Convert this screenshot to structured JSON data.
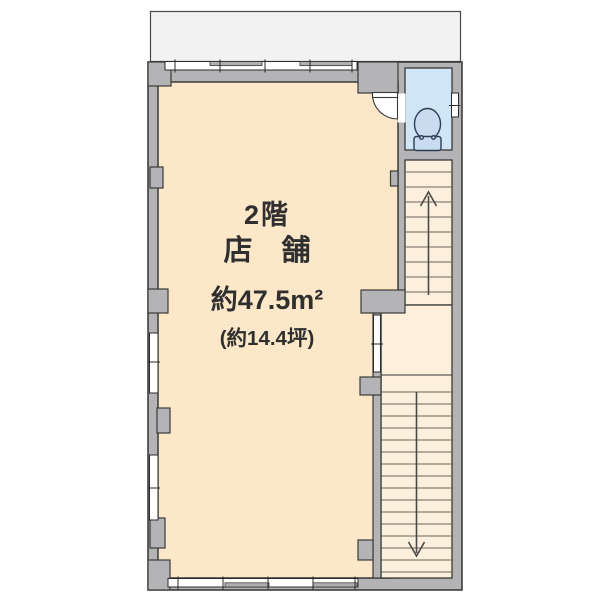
{
  "plan": {
    "labels": {
      "floor": "2階",
      "room_type": "店　舗",
      "area_sqm": "約47.5m²",
      "area_tsubo": "(約14.4坪)"
    },
    "stairs": {
      "upper_flight_direction": "up",
      "lower_flight_direction": "down"
    },
    "icons": {
      "toilet": "toilet-icon",
      "stairs_up": "up-arrow-icon",
      "stairs_down": "down-arrow-icon"
    },
    "colors": {
      "wall": "#B4B4B6",
      "wall_outline": "#3A3A3A",
      "shop_floor": "#FCE8C8",
      "stair_floor": "#FCEFDC",
      "toilet_floor": "#D0E5F6",
      "toilet_fixture": "#C9DCEF",
      "balcony": "#F2F2F3",
      "window": "#FFFFFF",
      "step_line": "#6E675C",
      "arrow": "#4A4A4A",
      "text": "#2F2F2F"
    }
  }
}
